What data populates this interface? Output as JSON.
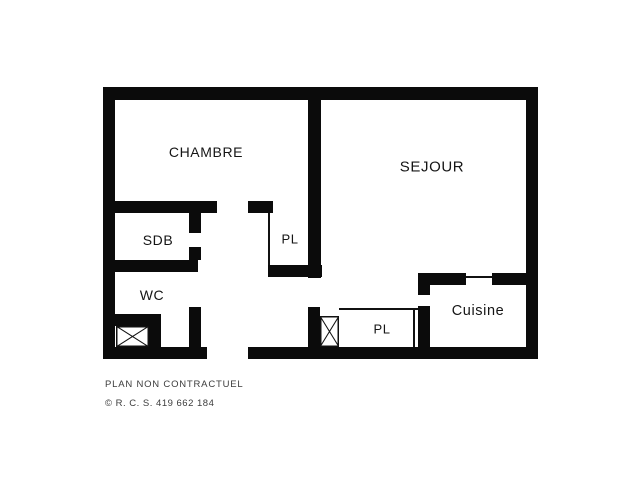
{
  "page": {
    "background": "#ffffff"
  },
  "floorplan": {
    "wall_color": "#0b0b0b",
    "thin_line_color": "#111111",
    "rooms": [
      {
        "id": "chambre",
        "label": "CHAMBRE",
        "x": 206,
        "y": 152,
        "size": 14
      },
      {
        "id": "sejour",
        "label": "SEJOUR",
        "x": 432,
        "y": 167,
        "size": 15
      },
      {
        "id": "sdb",
        "label": "SDB",
        "x": 158,
        "y": 240,
        "size": 14
      },
      {
        "id": "wc",
        "label": "WC",
        "x": 152,
        "y": 295,
        "size": 14
      },
      {
        "id": "pl-hall",
        "label": "PL",
        "x": 290,
        "y": 239,
        "size": 13
      },
      {
        "id": "pl-entry",
        "label": "PL",
        "x": 382,
        "y": 329,
        "size": 13
      },
      {
        "id": "cuisine",
        "label": "Cuisine",
        "x": 478,
        "y": 311,
        "size": 14.5
      }
    ],
    "walls": [
      {
        "name": "exterior-wall-top",
        "x": 103,
        "y": 87,
        "w": 435,
        "h": 13
      },
      {
        "name": "exterior-wall-left",
        "x": 103,
        "y": 87,
        "w": 12,
        "h": 272
      },
      {
        "name": "exterior-wall-right",
        "x": 526,
        "y": 87,
        "w": 12,
        "h": 272
      },
      {
        "name": "exterior-wall-bottom-left",
        "x": 103,
        "y": 347,
        "w": 104,
        "h": 12
      },
      {
        "name": "exterior-wall-bottom-right",
        "x": 248,
        "y": 347,
        "w": 290,
        "h": 12
      },
      {
        "name": "partition-sejour-upper",
        "x": 308,
        "y": 100,
        "w": 13,
        "h": 178
      },
      {
        "name": "partition-sejour-lower",
        "x": 308,
        "y": 307,
        "w": 12,
        "h": 40
      },
      {
        "name": "chambre-south-wall-west",
        "x": 115,
        "y": 201,
        "w": 102,
        "h": 12
      },
      {
        "name": "chambre-south-wall-east",
        "x": 248,
        "y": 201,
        "w": 25,
        "h": 12
      },
      {
        "name": "sdb-door-jamb-upper",
        "x": 189,
        "y": 213,
        "w": 12,
        "h": 20
      },
      {
        "name": "sdb-door-jamb-lower",
        "x": 189,
        "y": 247,
        "w": 12,
        "h": 13
      },
      {
        "name": "sdb-wc-divider",
        "x": 115,
        "y": 260,
        "w": 83,
        "h": 12
      },
      {
        "name": "wc-east-wall",
        "x": 189,
        "y": 307,
        "w": 12,
        "h": 40
      },
      {
        "name": "duct-enclosure-top",
        "x": 115,
        "y": 314,
        "w": 46,
        "h": 12
      },
      {
        "name": "duct-enclosure-right",
        "x": 149,
        "y": 326,
        "w": 12,
        "h": 21
      },
      {
        "name": "pl-hall-south-wall",
        "x": 268,
        "y": 265,
        "w": 54,
        "h": 12
      },
      {
        "name": "cuisine-west-jamb",
        "x": 418,
        "y": 273,
        "w": 12,
        "h": 22
      },
      {
        "name": "cuisine-west-wall",
        "x": 418,
        "y": 306,
        "w": 12,
        "h": 41
      },
      {
        "name": "cuisine-north-wall-west",
        "x": 418,
        "y": 273,
        "w": 48,
        "h": 12
      },
      {
        "name": "cuisine-north-wall-east",
        "x": 492,
        "y": 273,
        "w": 34,
        "h": 12
      }
    ],
    "thin_lines": [
      {
        "name": "pl-hall-west-line",
        "x": 268,
        "y": 213,
        "w": 2,
        "h": 52
      },
      {
        "name": "pl-entry-top-line",
        "x": 339,
        "y": 308,
        "w": 79,
        "h": 2
      },
      {
        "name": "pl-entry-right-line",
        "x": 413,
        "y": 308,
        "w": 2,
        "h": 39
      },
      {
        "name": "cuisine-opening-line",
        "x": 466,
        "y": 276,
        "w": 26,
        "h": 2
      }
    ],
    "duct_boxes": [
      {
        "name": "duct-box-wc",
        "x": 116,
        "y": 326,
        "w": 33,
        "h": 21
      },
      {
        "name": "duct-box-entry",
        "x": 320,
        "y": 316,
        "w": 19,
        "h": 31
      }
    ]
  },
  "footer": {
    "line1": "PLAN NON CONTRACTUEL",
    "line2": "© R. C. S. 419 662 184"
  }
}
